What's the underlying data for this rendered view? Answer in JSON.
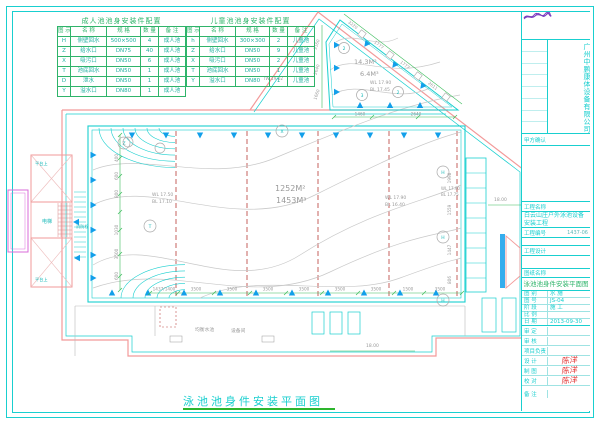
{
  "sheet": {
    "drawing_title": "泳池池身件安装平面图"
  },
  "tables": {
    "adult": {
      "title": "成人池池身安装件配置",
      "headers": [
        "图 示",
        "名 称",
        "规 格",
        "数 量",
        "备 注"
      ],
      "rows": [
        [
          "H",
          "侧壁回水",
          "500×500",
          "4",
          "成人池"
        ],
        [
          "Z",
          "给水口",
          "DN75",
          "40",
          "成人池"
        ],
        [
          "X",
          "吸污口",
          "DN50",
          "6",
          "成人池"
        ],
        [
          "T",
          "池底回水",
          "DN50",
          "1",
          "成人池"
        ],
        [
          "D",
          "泄水",
          "DN50",
          "1",
          "成人池"
        ],
        [
          "Y",
          "溢水口",
          "DN80",
          "1",
          "成人池"
        ]
      ]
    },
    "child": {
      "title": "儿童池池身安装件配置",
      "headers": [
        "图 示",
        "名 称",
        "规 格",
        "数 量",
        "备 注"
      ],
      "rows": [
        [
          "h",
          "侧壁回水",
          "300×300",
          "2",
          "儿童池"
        ],
        [
          "Z",
          "给水口",
          "DN50",
          "9",
          "儿童池"
        ],
        [
          "X",
          "吸污口",
          "DN50",
          "2",
          "儿童池"
        ],
        [
          "T",
          "池底回水",
          "DN50",
          "1",
          "儿童池"
        ],
        [
          "Y",
          "溢水口",
          "DN80",
          "1",
          "儿童池"
        ]
      ]
    }
  },
  "plan": {
    "main_pool": {
      "area": "1252M²",
      "volume": "1453M³",
      "wl_left": "WL 17.50",
      "bl_left": "BL 17.10",
      "wl_right": "WL 17.90",
      "bl_right": "BL 16.40",
      "wl_edge": "WL 17.90",
      "bl_edge": "BL 17.75",
      "dim_row": [
        "1437/1400",
        "3500",
        "3500",
        "3500",
        "3500",
        "3500",
        "3500",
        "1500",
        "3500"
      ],
      "dims_left": [
        "400",
        "600",
        "800",
        "1030",
        "3500",
        "600"
      ],
      "dims_right": [
        "1998",
        "1559",
        "1447",
        "806"
      ],
      "symbols": [
        "X",
        "H",
        "H",
        "H",
        "T",
        "Z"
      ]
    },
    "child_pool": {
      "area": "14.3M²",
      "volume": "6.4M³",
      "wl": "WL 17.90",
      "bl": "BL 17.45",
      "dims_top": [
        "3220",
        "1777",
        "1777",
        "2611"
      ],
      "dims_left": [
        "3160",
        "2640",
        "1660"
      ],
      "dims_bottom": [
        "1460",
        "2640"
      ],
      "symbols": [
        "2",
        "3",
        "2"
      ]
    },
    "labels": {
      "tw": "TW 19.02",
      "dim_right": "18.00",
      "dim_bottom": "18.00",
      "room_balance": "均衡水池",
      "room_equip": "设备间",
      "elevator": "电梯",
      "hydrant": "消防栓",
      "platform_upper": "平台上",
      "platform_lower": "平台上"
    }
  },
  "titleblock": {
    "company": "广州中鹏康体设备有限公司",
    "approval": {
      "label": "甲方确认",
      "value": ""
    },
    "project_name_label": "工程名称",
    "project_name": "白云山庄户外泳池设备安装工程",
    "project_no_label": "工程编号",
    "project_no": "1437-06",
    "design_label": "工程设计",
    "drawing_name_label": "图纸名称",
    "drawing_name": "泳池池身件安装平面图",
    "info": [
      {
        "label": "图 别",
        "value": "水 施"
      },
      {
        "label": "图 号",
        "value": "JS-04"
      },
      {
        "label": "阶 段",
        "value": "施 工"
      },
      {
        "label": "比 例",
        "value": ""
      },
      {
        "label": "日 期",
        "value": "2013-09-30"
      }
    ],
    "signatures": [
      {
        "label": "审 定",
        "value": ""
      },
      {
        "label": "审 核",
        "value": ""
      },
      {
        "label": "项目负责",
        "value": ""
      },
      {
        "label": "设 计",
        "value": "陈洋"
      },
      {
        "label": "制 图",
        "value": "陈洋"
      },
      {
        "label": "校 对",
        "value": "陈洋"
      },
      {
        "label": "备 注",
        "value": ""
      }
    ]
  },
  "colors": {
    "cyan": "#19cfcf",
    "green": "#2fb46a",
    "dim_green": "#3dbd5d",
    "wall_red": "#f29a9a",
    "lane_red": "#c0504d",
    "marker_blue": "#129fea",
    "magenta": "#da6bda",
    "gray": "#9a9a9a",
    "sig_purple": "#7b3fbf",
    "sig_red": "#e03030"
  }
}
